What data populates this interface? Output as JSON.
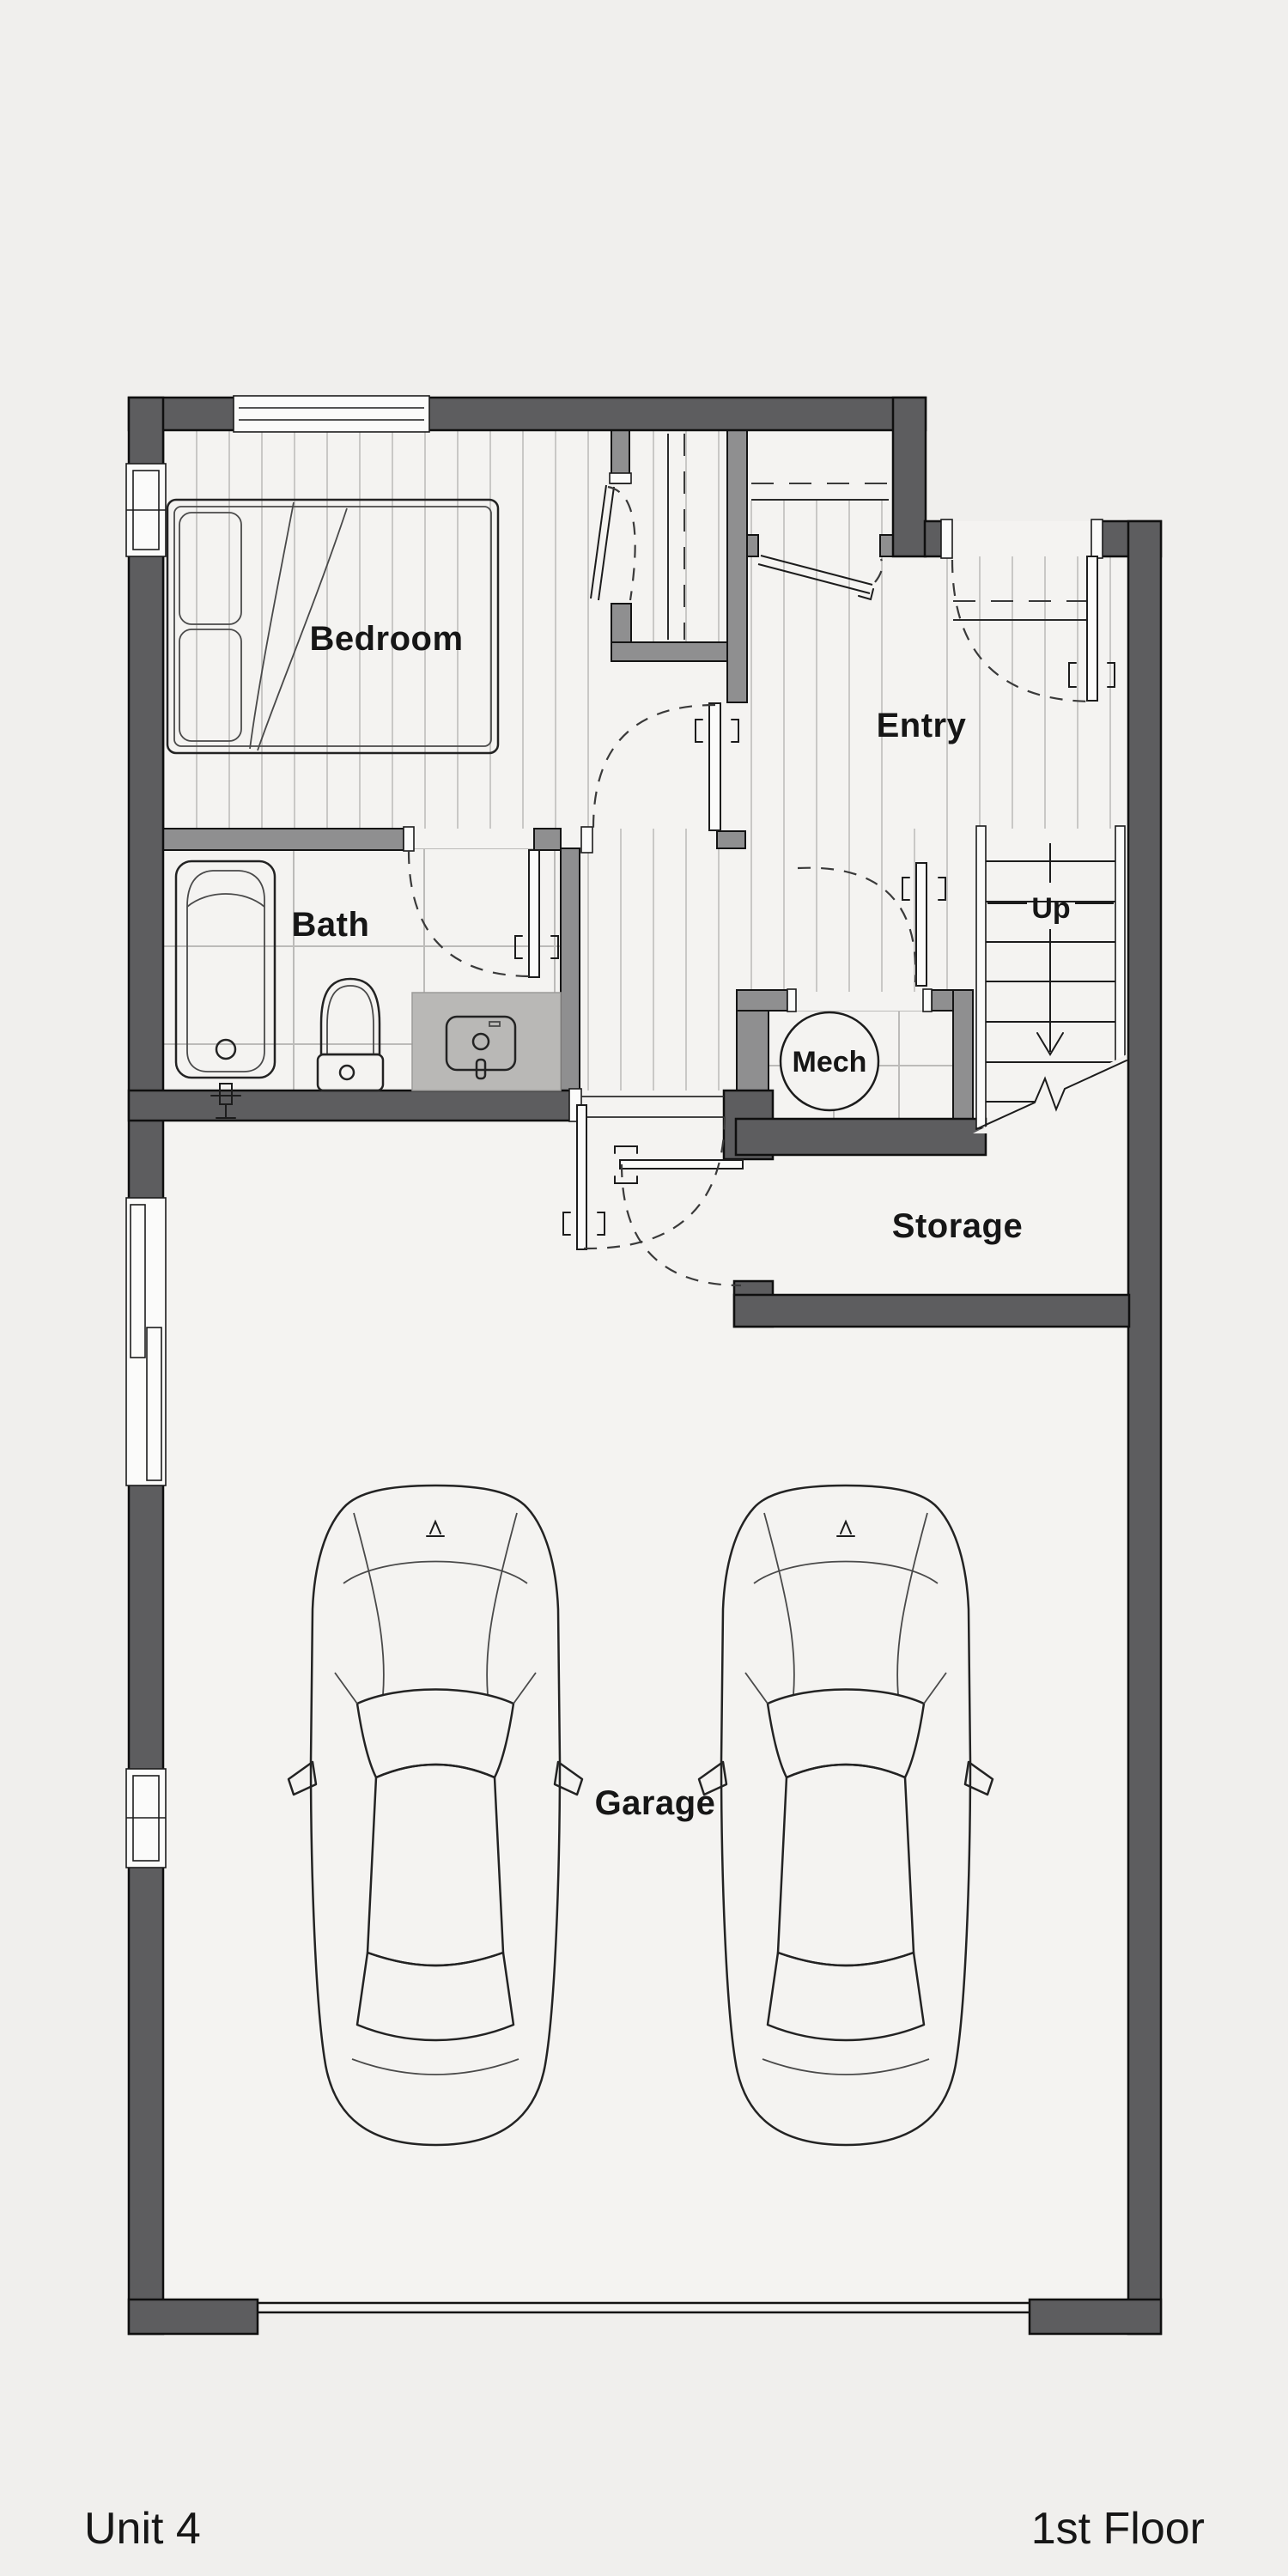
{
  "plan": {
    "unit_label": "Unit 4",
    "floor_label": "1st Floor",
    "rooms": {
      "bedroom": "Bedroom",
      "bath": "Bath",
      "entry": "Entry",
      "mech": "Mech",
      "storage": "Storage",
      "garage": "Garage"
    },
    "stairs": {
      "direction_label": "Up"
    },
    "features": {
      "cars_in_garage": 2,
      "window_icons": [
        "bedroom-north-window",
        "bedroom-west-window",
        "garage-west-window-tall",
        "garage-west-window-small"
      ],
      "door_icons": [
        "front-door",
        "bedroom-door",
        "bath-door",
        "hall-door",
        "mech-door",
        "garage-hall-double-door",
        "coat-closet-door"
      ],
      "garage_door_icon": "garage-overhead-door"
    },
    "colors": {
      "background": "#f0efed",
      "floor": "#f4f3f1",
      "exterior_wall": "#5d5d5f",
      "interior_wall": "#8f8f90",
      "hatch_line": "#c9c8c6",
      "tile_line": "#bcbbb9",
      "counter": "#b9b8b6",
      "text": "#161616"
    }
  }
}
